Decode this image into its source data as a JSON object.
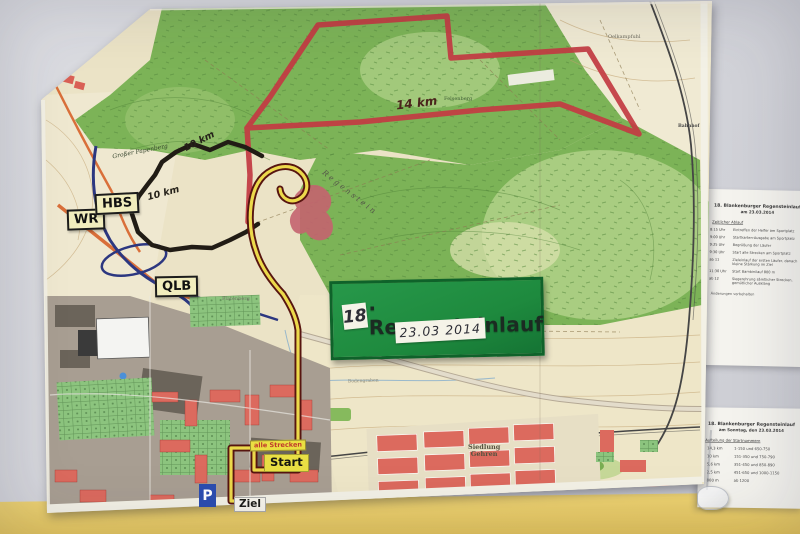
{
  "event_sign": {
    "number": "18",
    "title_rest": ". Regensteinlauf",
    "date": "23.03 2014"
  },
  "road_signs": {
    "wr": "WR",
    "hbs": "HBS",
    "qlb": "QLB",
    "parking": "P"
  },
  "course_signs": {
    "alle_strecken": "alle Strecken",
    "start": "Start",
    "ziel": "Ziel"
  },
  "route_labels": {
    "red_distance": "14 km",
    "black_distance_upper": "10 km",
    "black_distance_lower": "10 km"
  },
  "map_labels": {
    "grosser_papenberg": "Großer Papenberg",
    "regenstein": "Regenstein",
    "siedlung_line1": "Siedlung",
    "siedlung_line2": "Gehren",
    "oelkampfuhl": "Oelkampfuhl",
    "felsenberg": "Felsenberg",
    "bahnhof": "Bahnhof",
    "bodengraben": "Bodengraben",
    "platenberg": "Platenberg"
  },
  "papers": {
    "upper": {
      "title1": "18. Blankenburger Regensteinlauf",
      "title2": "am 23.03.2014",
      "subtitle": "Zeitlicher Ablauf",
      "rows": [
        {
          "time": "8:15 Uhr",
          "text": "Eintreffen der Helfer am Sportplatz"
        },
        {
          "time": "9:00 Uhr",
          "text": "Startkarten-Ausgabe am Sportplatz"
        },
        {
          "time": "9:25 Uhr",
          "text": "Begrüßung der Läufer"
        },
        {
          "time": "9:30 Uhr",
          "text": "Start alle Strecken am Sportplatz"
        },
        {
          "time": "ab 11",
          "text": "Zieleinlauf der ersten Läufer, danach kleine Stärkung im Ziel"
        },
        {
          "time": "11:30 Uhr",
          "text": "Start Bambinilauf 800 m"
        },
        {
          "time": "ab 12",
          "text": "Siegerehrung sämtlicher Strecken, gemütlicher Ausklang"
        }
      ],
      "footer": "Änderungen vorbehalten"
    },
    "lower": {
      "title1": "18. Blankenburger Regensteinlauf",
      "title2": "am Sonntag, den 23.03.2014",
      "subtitle": "Aufteilung der Startnummern",
      "rows": [
        {
          "dist": "14,3 km",
          "nums": "1-150 und 650-750"
        },
        {
          "dist": "10 km",
          "nums": "151-350 und 750-790"
        },
        {
          "dist": "5,6 km",
          "nums": "351-450 und 850-890"
        },
        {
          "dist": "2,5 km",
          "nums": "451-650 und 1000-1150"
        },
        {
          "dist": "800 m",
          "nums": "ab 1200"
        }
      ]
    }
  },
  "colors": {
    "wall": "#d4d5da",
    "wall_yellow_band": "#e8cc67",
    "event_sign_green": "#1e8a3e",
    "route_red": "#c33b43",
    "route_black": "#211c15",
    "route_yellow": "#ecd94b",
    "forest_green": "#7cb357",
    "urban_red": "#dc6a5e",
    "road_blue": "#2c3780",
    "road_orange": "#d96f3a"
  }
}
